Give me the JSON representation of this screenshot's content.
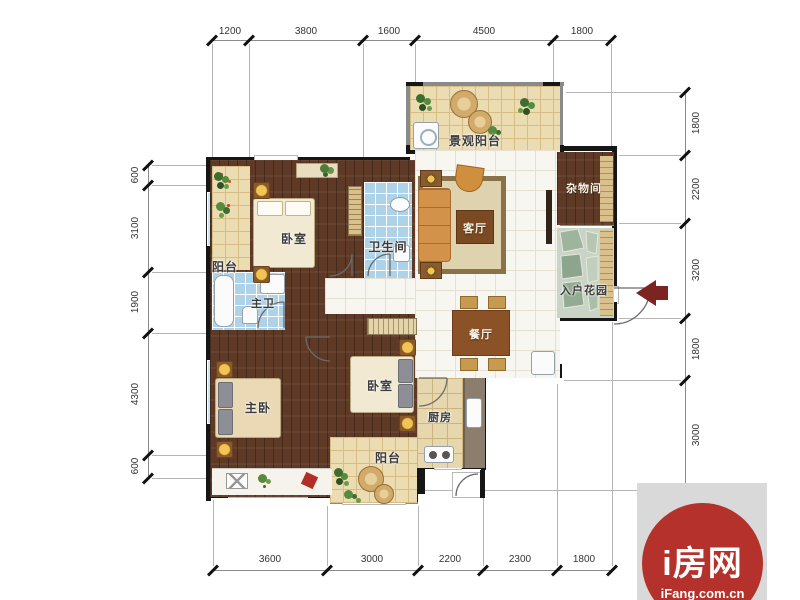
{
  "dimensions": {
    "top": [
      "1200",
      "3800",
      "1600",
      "4500",
      "1800"
    ],
    "bottom": [
      "3600",
      "3000",
      "2200",
      "2300",
      "1800"
    ],
    "left": [
      "600",
      "3100",
      "1900",
      "4300",
      "600"
    ],
    "right": [
      "1800",
      "2200",
      "3200",
      "1800",
      "3000"
    ]
  },
  "rooms": {
    "landscape_balcony": "景观阳台",
    "balcony_left": "阳台",
    "bedroom_top": "卧室",
    "bathroom": "卫生间",
    "living_room": "客厅",
    "storage_room": "杂物间",
    "entry_garden": "入户花园",
    "master_bathroom": "主卫",
    "dining_room": "餐厅",
    "master_bedroom": "主卧",
    "bedroom_bottom": "卧室",
    "kitchen": "厨房",
    "balcony_bottom": "阳台"
  },
  "branding": {
    "site_name": "i房网",
    "site_domain": "iFang.com.cn"
  },
  "colors": {
    "logo_red": "#b5312b",
    "entry_arrow": "#7b2422",
    "dark_wood_floor": "#5e3a26",
    "tan_tile": "#ecdcb2",
    "blue_tile": "#aed2e8",
    "white_tile": "#f8f6f0",
    "stone_floor": "#c9d3c6",
    "wall_black": "#161616"
  }
}
